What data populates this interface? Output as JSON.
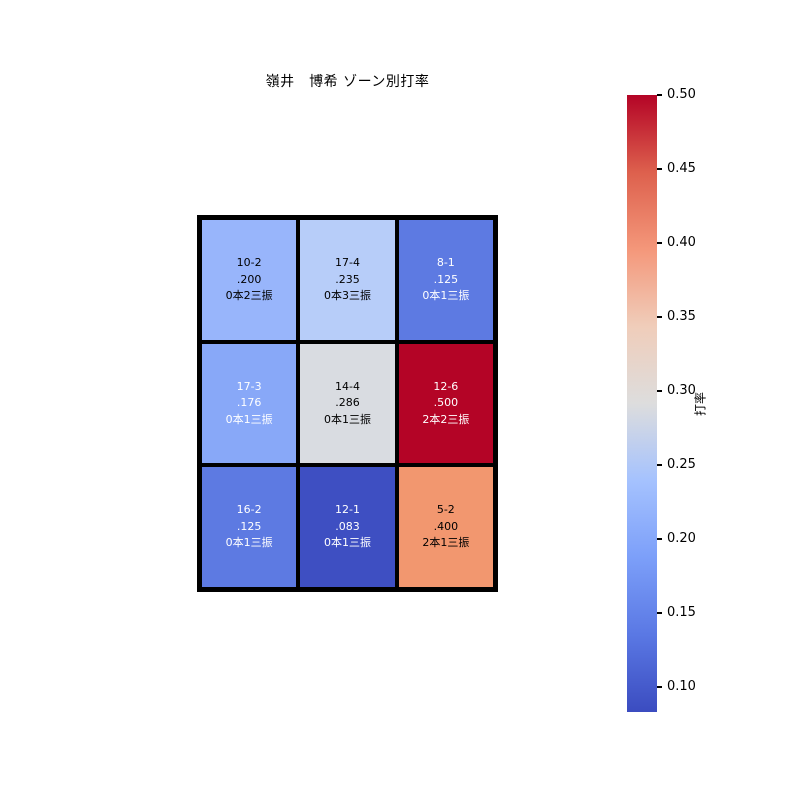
{
  "page": {
    "background": "#ffffff"
  },
  "chart_data": {
    "type": "heatmap",
    "title": "嶺井　博希 ゾーン別打率",
    "rows": 3,
    "cols": 3,
    "grid_line_color": "#000000",
    "cells": [
      {
        "row": 0,
        "col": 0,
        "lines": [
          "10-2",
          ".200",
          "0本2三振"
        ],
        "value": 0.2,
        "bg": "#98b5fb",
        "fg": "#000000"
      },
      {
        "row": 0,
        "col": 1,
        "lines": [
          "17-4",
          ".235",
          "0本3三振"
        ],
        "value": 0.235,
        "bg": "#b7cdf9",
        "fg": "#000000"
      },
      {
        "row": 0,
        "col": 2,
        "lines": [
          "8-1",
          ".125",
          "0本1三振"
        ],
        "value": 0.125,
        "bg": "#5d7ae2",
        "fg": "#ffffff"
      },
      {
        "row": 1,
        "col": 0,
        "lines": [
          "17-3",
          ".176",
          "0本1三振"
        ],
        "value": 0.176,
        "bg": "#88a8f8",
        "fg": "#ffffff"
      },
      {
        "row": 1,
        "col": 1,
        "lines": [
          "14-4",
          ".286",
          "0本1三振"
        ],
        "value": 0.286,
        "bg": "#d9dce1",
        "fg": "#000000"
      },
      {
        "row": 1,
        "col": 2,
        "lines": [
          "12-6",
          ".500",
          "2本2三振"
        ],
        "value": 0.5,
        "bg": "#b40426",
        "fg": "#ffffff"
      },
      {
        "row": 2,
        "col": 0,
        "lines": [
          "16-2",
          ".125",
          "0本1三振"
        ],
        "value": 0.125,
        "bg": "#5d7ae2",
        "fg": "#ffffff"
      },
      {
        "row": 2,
        "col": 1,
        "lines": [
          "12-1",
          ".083",
          "0本1三振"
        ],
        "value": 0.083,
        "bg": "#3e4fc2",
        "fg": "#ffffff"
      },
      {
        "row": 2,
        "col": 2,
        "lines": [
          "5-2",
          ".400",
          "2本1三振"
        ],
        "value": 0.4,
        "bg": "#f2976f",
        "fg": "#000000"
      }
    ],
    "colorbar": {
      "label": "打率",
      "min": 0.083,
      "max": 0.5,
      "colormap": "coolwarm",
      "ticks": [
        "0.50",
        "0.45",
        "0.40",
        "0.35",
        "0.30",
        "0.25",
        "0.20",
        "0.15",
        "0.10"
      ]
    }
  }
}
